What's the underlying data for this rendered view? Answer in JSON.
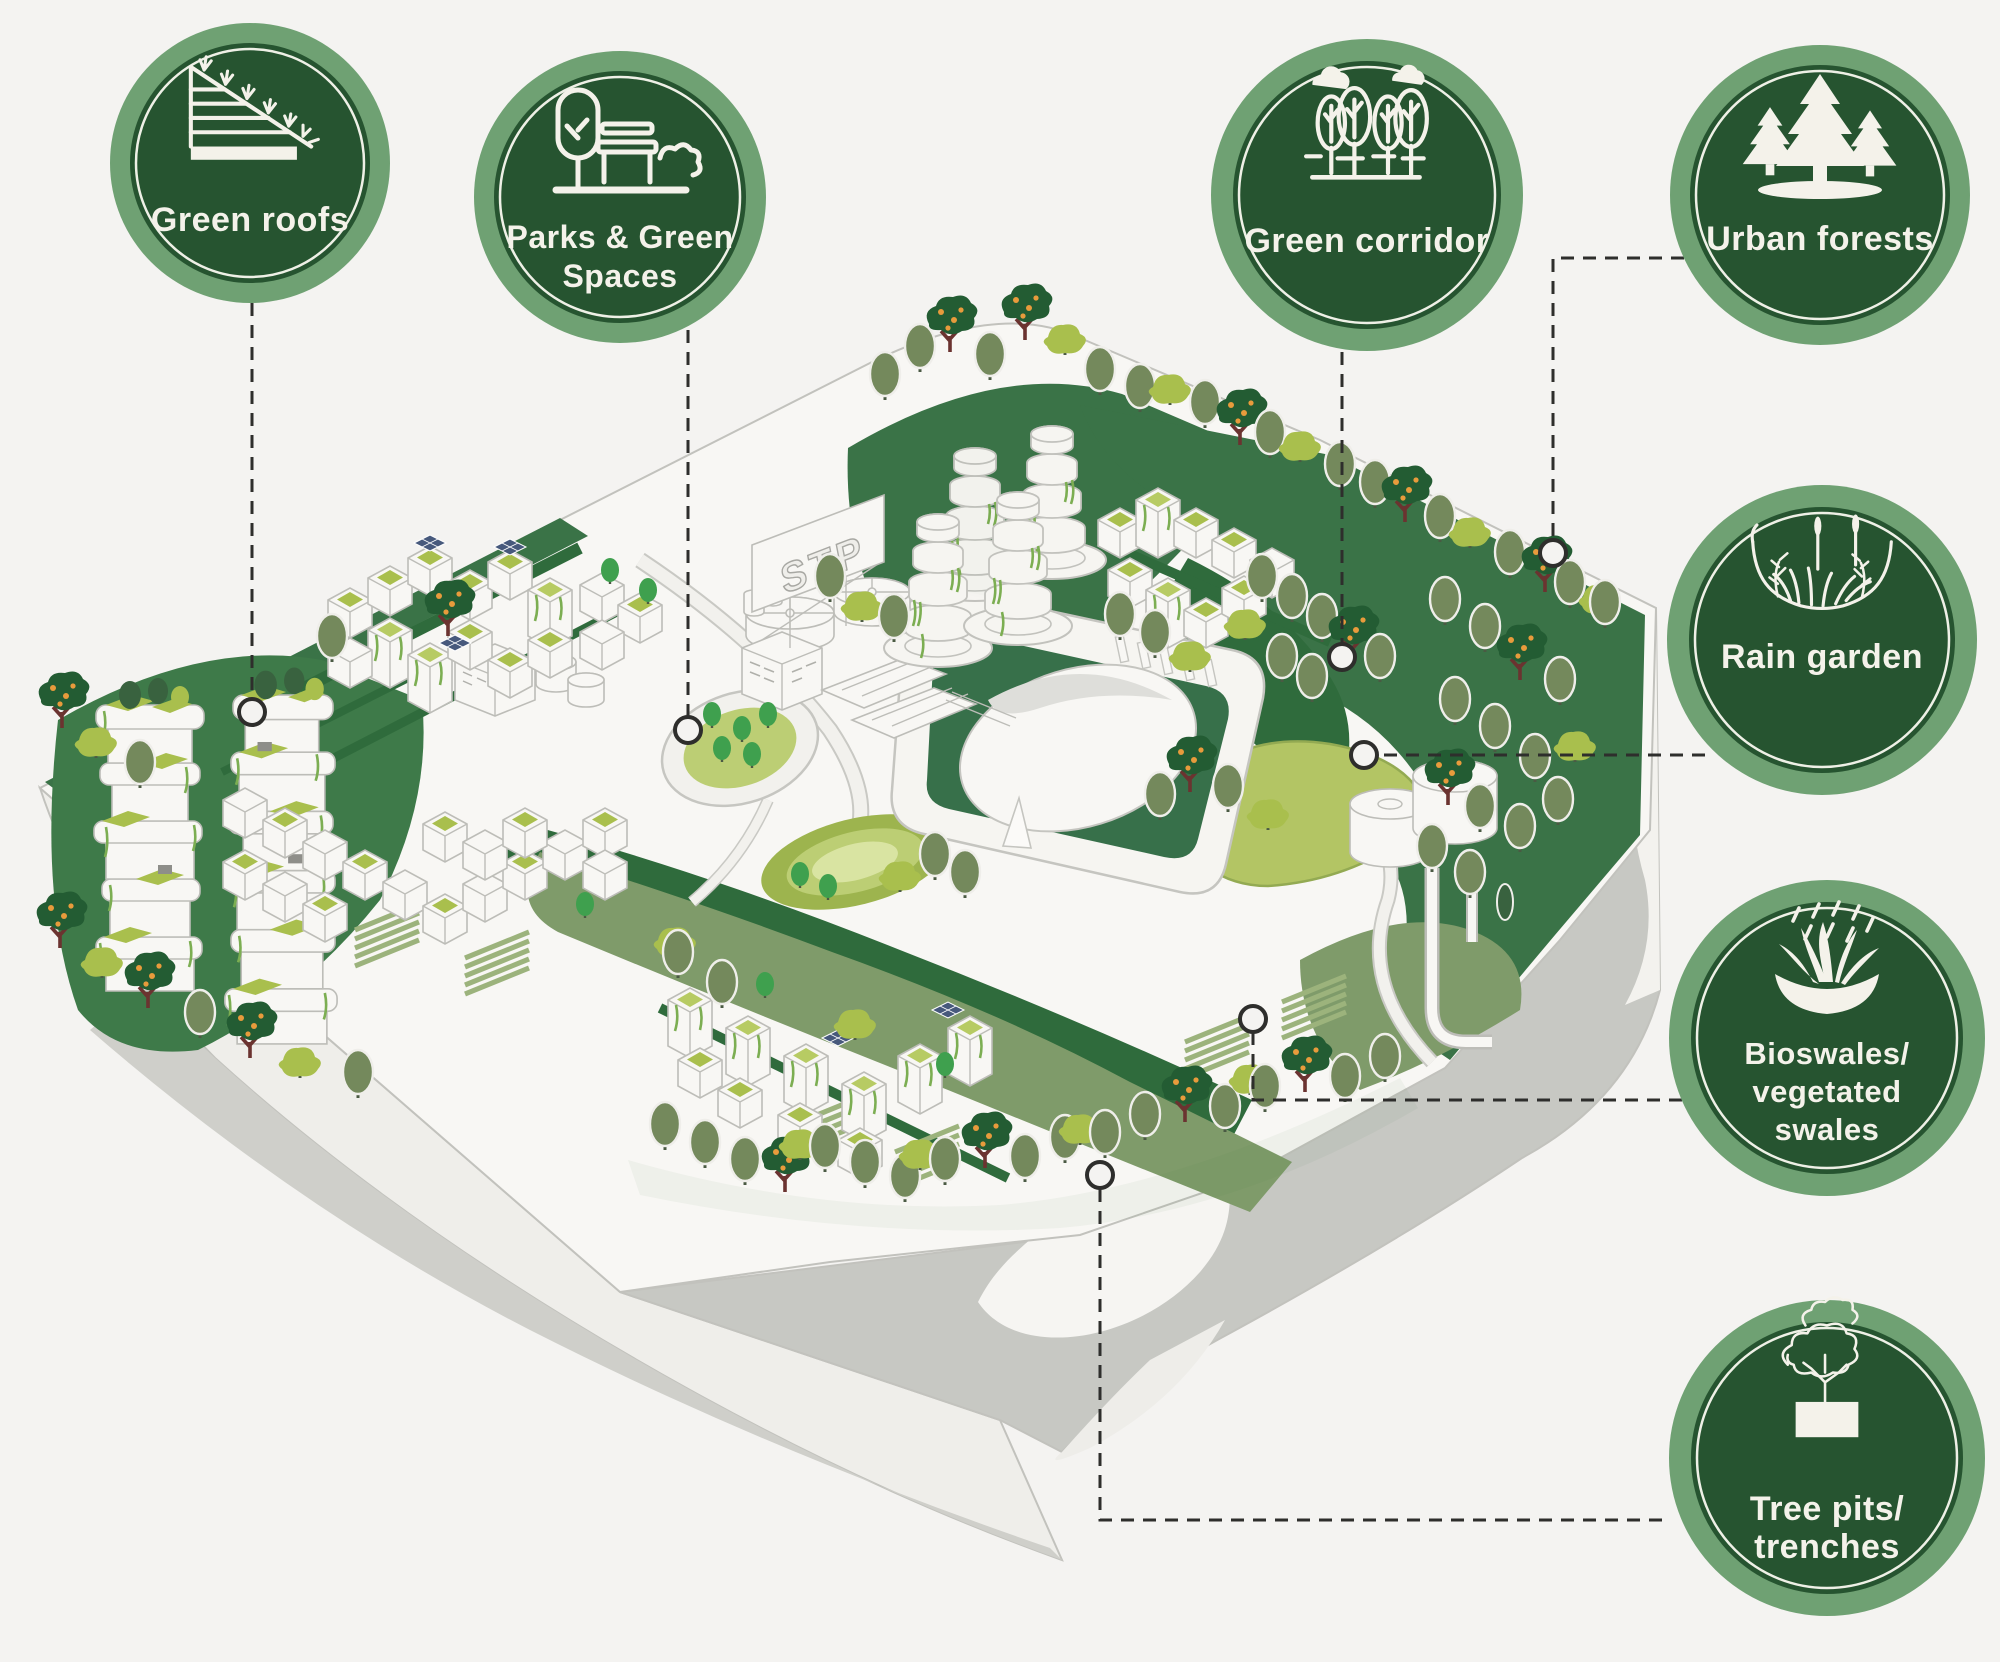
{
  "figure_type": "green-infrastructure infographic",
  "badges": [
    {
      "id": "green-roofs",
      "label": "Green roofs",
      "lines": [
        "Green roofs"
      ],
      "icon": "green-roof-icon"
    },
    {
      "id": "parks-green-spaces",
      "label": "Parks & Green Spaces",
      "lines": [
        "Parks & Green",
        "Spaces"
      ],
      "icon": "park-tree-bench-icon"
    },
    {
      "id": "green-corridor",
      "label": "Green corridor",
      "lines": [
        "Green corridor"
      ],
      "icon": "tree-row-clouds-icon"
    },
    {
      "id": "urban-forests",
      "label": "Urban forests",
      "lines": [
        "Urban forests"
      ],
      "icon": "pine-forest-icon"
    },
    {
      "id": "rain-garden",
      "label": "Rain garden",
      "lines": [
        "Rain garden"
      ],
      "icon": "rain-garden-plants-icon"
    },
    {
      "id": "bioswales",
      "label": "Bioswales/vegetated swales",
      "lines": [
        "Bioswales/",
        "vegetated",
        "swales"
      ],
      "icon": "bioswale-grass-rain-icon"
    },
    {
      "id": "tree-pits",
      "label": "Tree pits/trenches",
      "lines": [
        "Tree pits/",
        "trenches"
      ],
      "icon": "tree-pit-icon"
    }
  ],
  "illustration": {
    "sign_text": "STP",
    "elements": [
      "isometric city block",
      "vertical forest towers",
      "sewage treatment plant",
      "tiered greenery towers",
      "central stadium park",
      "water tanks",
      "urban forest hill",
      "bioswale band",
      "tree-lined streets",
      "rain garden pond"
    ]
  },
  "colors": {
    "bg": "#f4f3f1",
    "badge_ring": "#6fa173",
    "badge_disc": "#265430",
    "cream": "#f4f2ea",
    "connector": "#2e2e2c",
    "plate": "#f8f7f4",
    "cliff_light": "#e6e5e1",
    "cliff_gray": "#cfcfca",
    "slope_gray": "#c7c8c3",
    "green": "#3a7347",
    "green_dark": "#2f6b3c",
    "forest": "#235c33",
    "sage_band": "#7f9b6a",
    "sage_tree": "#74895c",
    "olive": "#a9bf4d",
    "olive_light": "#c3d27c",
    "pond": "#b5c75f",
    "bright_green": "#3fa04e",
    "orange": "#e89b3c",
    "trunk": "#6b3330",
    "solar": "#47597c",
    "vine": "#7cae52",
    "outline": "#bdbdb8"
  }
}
